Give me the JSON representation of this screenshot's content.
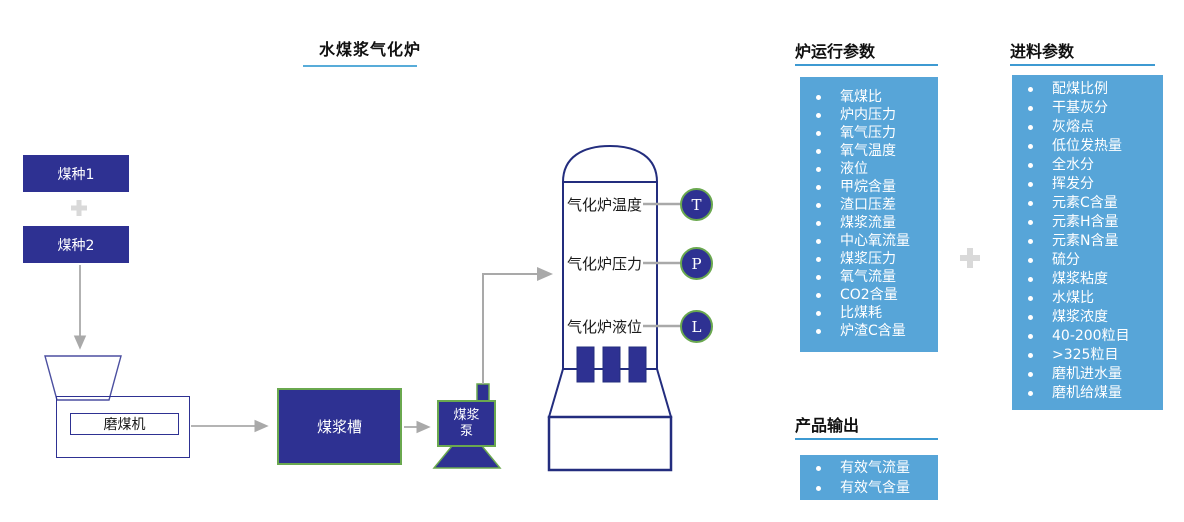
{
  "title": "水煤浆气化炉",
  "flow": {
    "coal1": "煤种1",
    "plus": "+",
    "coal2": "煤种2",
    "mill": "磨煤机",
    "slurry_tank": "煤浆槽",
    "slurry_pump_lines": [
      "煤浆",
      "泵"
    ],
    "gasifier_sensors": [
      {
        "label": "气化炉温度",
        "tag": "T"
      },
      {
        "label": "气化炉压力",
        "tag": "P"
      },
      {
        "label": "气化炉液位",
        "tag": "L"
      }
    ]
  },
  "panels": {
    "furnace": {
      "title": "炉运行参数",
      "items": [
        "氧煤比",
        "炉内压力",
        "氧气压力",
        "氧气温度",
        "液位",
        "甲烷含量",
        "渣口压差",
        "煤浆流量",
        "中心氧流量",
        "煤浆压力",
        "氧气流量",
        "CO2含量",
        "比煤耗",
        "炉渣C含量"
      ]
    },
    "feed": {
      "title": "进料参数",
      "items": [
        "配煤比例",
        "干基灰分",
        "灰熔点",
        "低位发热量",
        "全水分",
        "挥发分",
        "元素C含量",
        "元素H含量",
        "元素N含量",
        "硫分",
        "煤浆粘度",
        "水煤比",
        "煤浆浓度",
        "40-200粒目",
        ">325粒目",
        "磨机进水量",
        "磨机给煤量"
      ]
    },
    "product": {
      "title": "产品输出",
      "items": [
        "有效气流量",
        "有效气含量"
      ]
    }
  },
  "colors": {
    "navy": "#2e3192",
    "outline_navy": "#232d7e",
    "panel_blue": "#57a5d8",
    "underline_blue": "#3e9ad2",
    "green_border": "#6aa84f",
    "arrow_gray": "#a9a9a9",
    "plus_gray": "#d9d9d9"
  }
}
